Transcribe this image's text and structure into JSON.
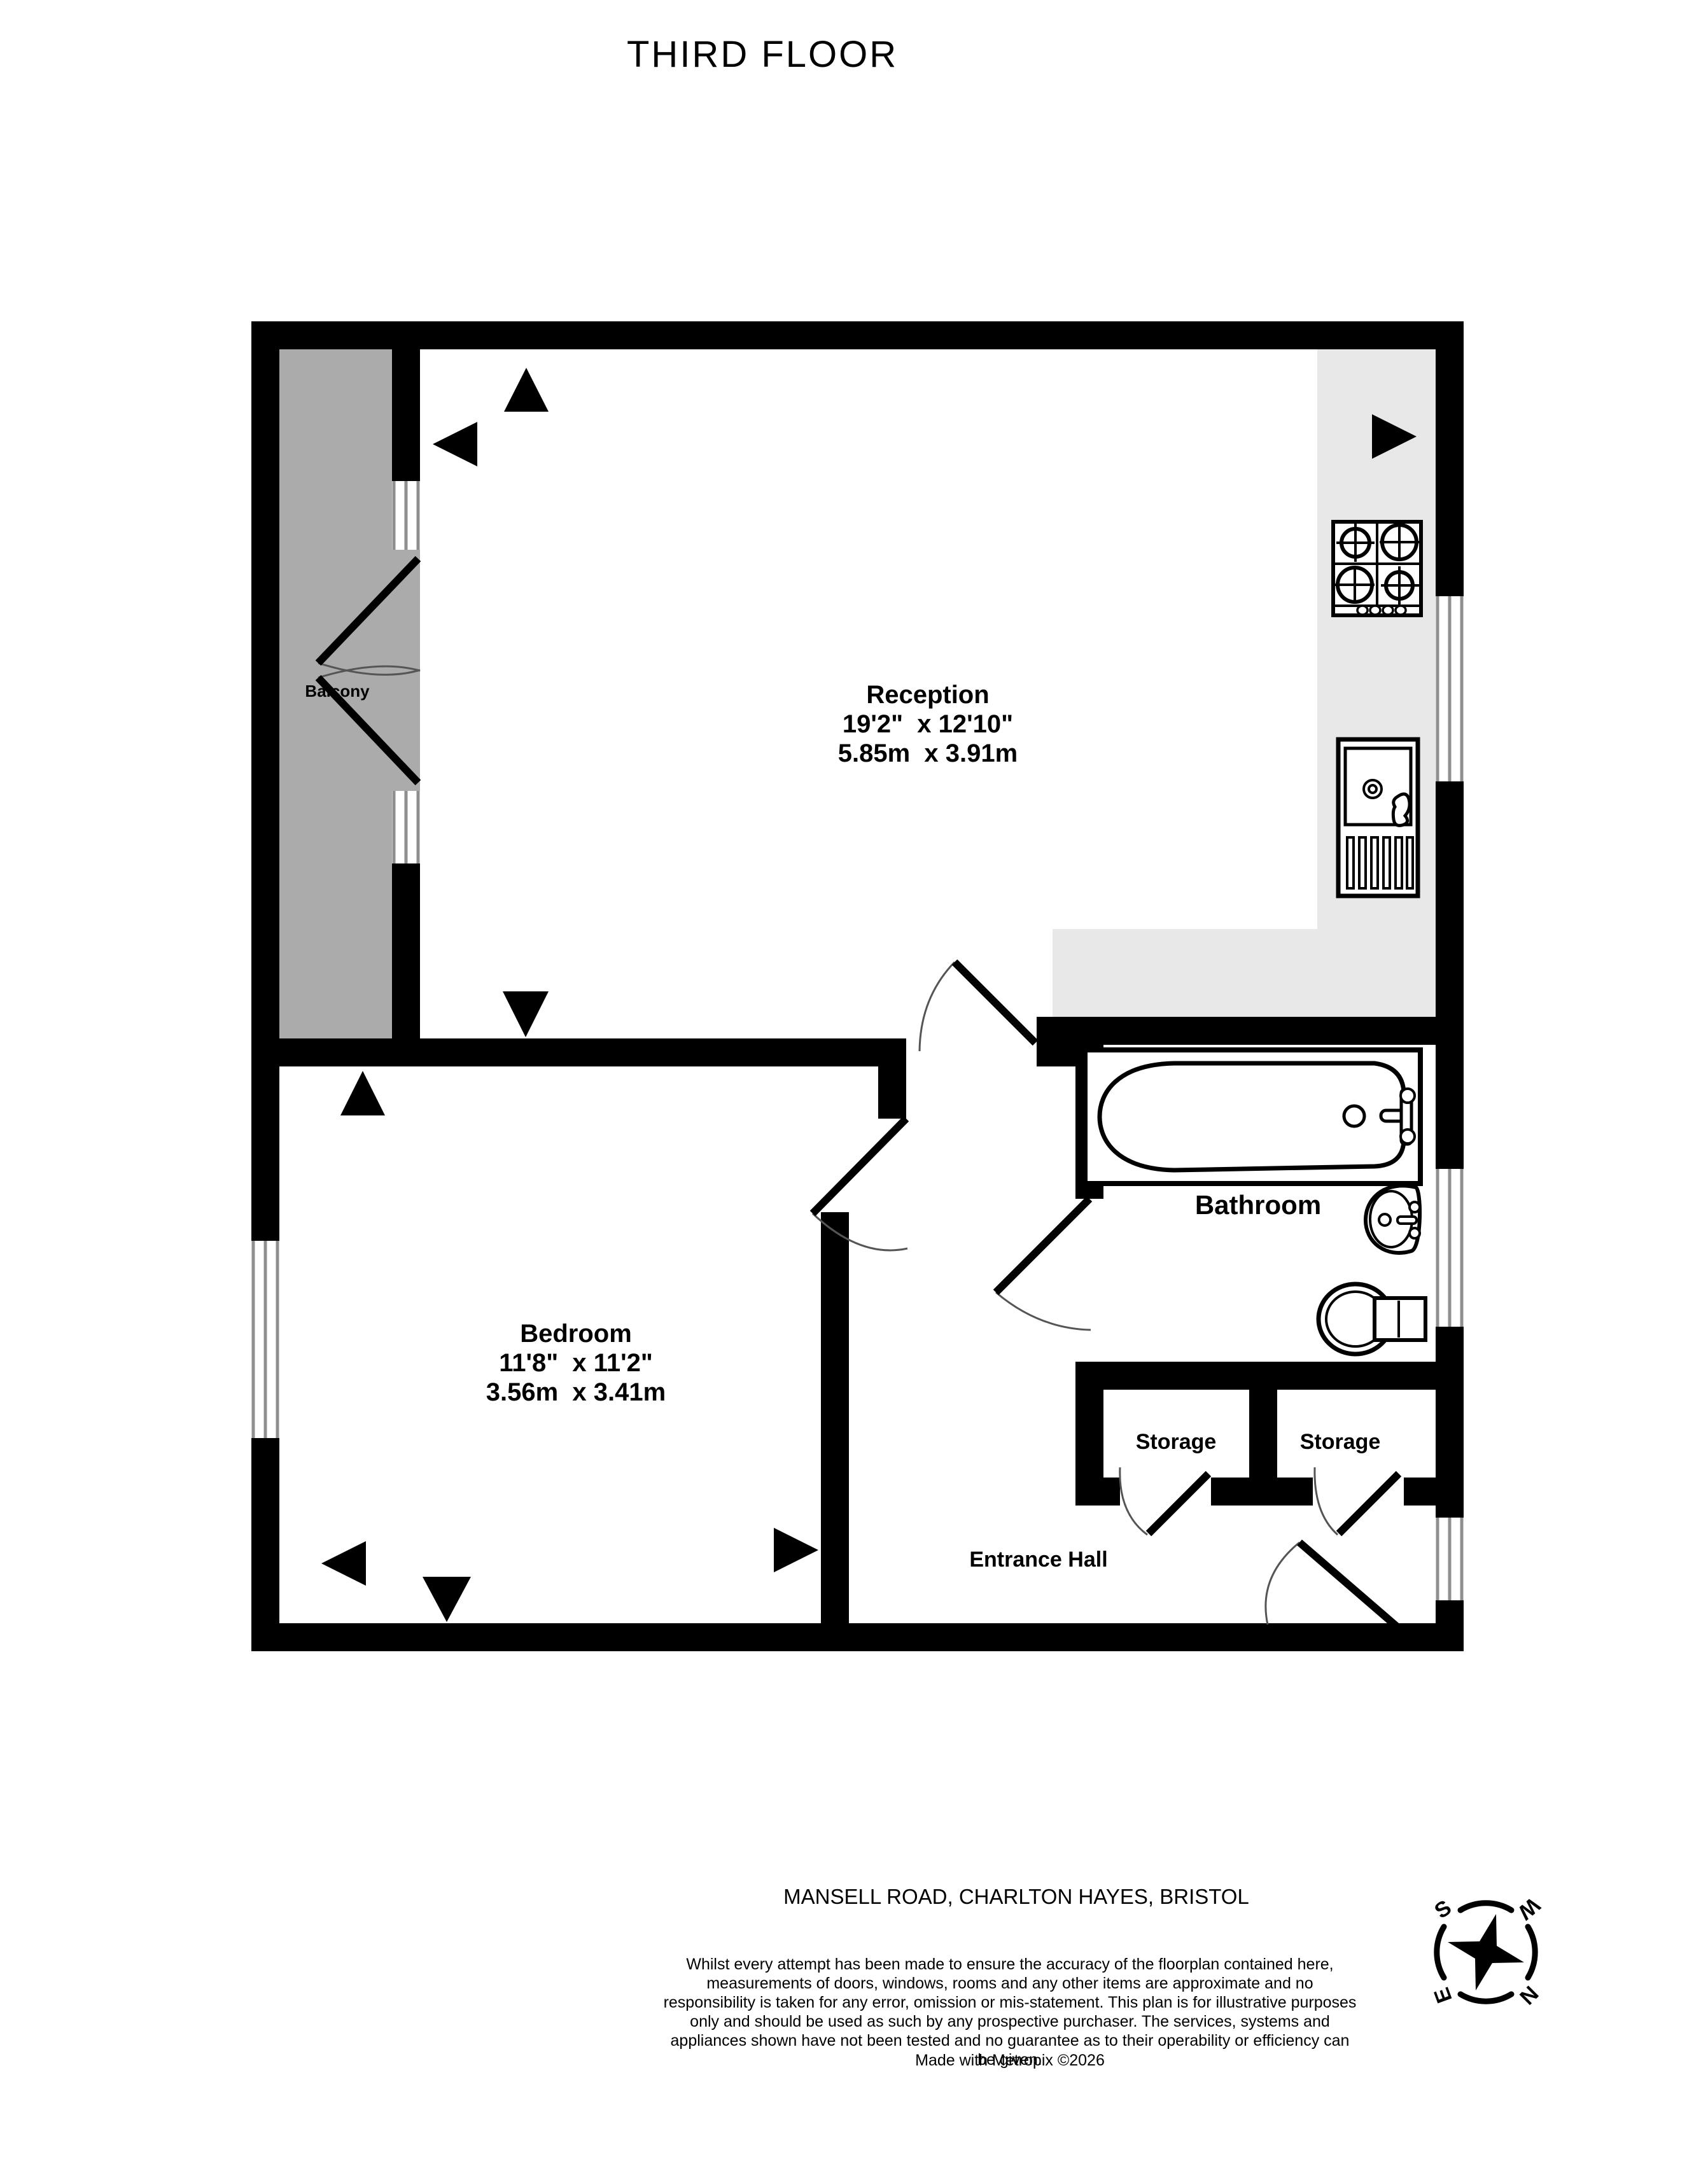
{
  "title": "THIRD FLOOR",
  "address": "MANSELL ROAD, CHARLTON HAYES, BRISTOL",
  "disclaimer": "Whilst every attempt has been made to ensure the accuracy of the floorplan contained here, measurements of doors, windows, rooms and any other items are approximate and no responsibility is taken for any error, omission or mis-statement. This plan is for illustrative purposes only and should be used as such by any prospective purchaser. The services, systems and appliances shown have not been tested and no guarantee as to their operability or efficiency can be given.",
  "made_with": "Made with Metropix ©2026",
  "rooms": {
    "reception": {
      "name": "Reception",
      "dims_imperial": "19'2\"  x 12'10\"",
      "dims_metric": "5.85m  x 3.91m"
    },
    "bedroom": {
      "name": "Bedroom",
      "dims_imperial": "11'8\"  x 11'2\"",
      "dims_metric": "3.56m  x 3.41m"
    },
    "bathroom": {
      "name": "Bathroom"
    },
    "balcony": {
      "name": "Balcony"
    },
    "storage1": {
      "name": "Storage"
    },
    "storage2": {
      "name": "Storage"
    },
    "entrance_hall": {
      "name": "Entrance Hall"
    }
  },
  "compass": {
    "n": "N",
    "s": "S",
    "e": "E",
    "w": "W"
  },
  "colors": {
    "wall": "#000000",
    "balcony_floor": "#ABABAB",
    "kitchen_floor": "#E8E8E8",
    "window_frame": "#8F8F8F"
  }
}
